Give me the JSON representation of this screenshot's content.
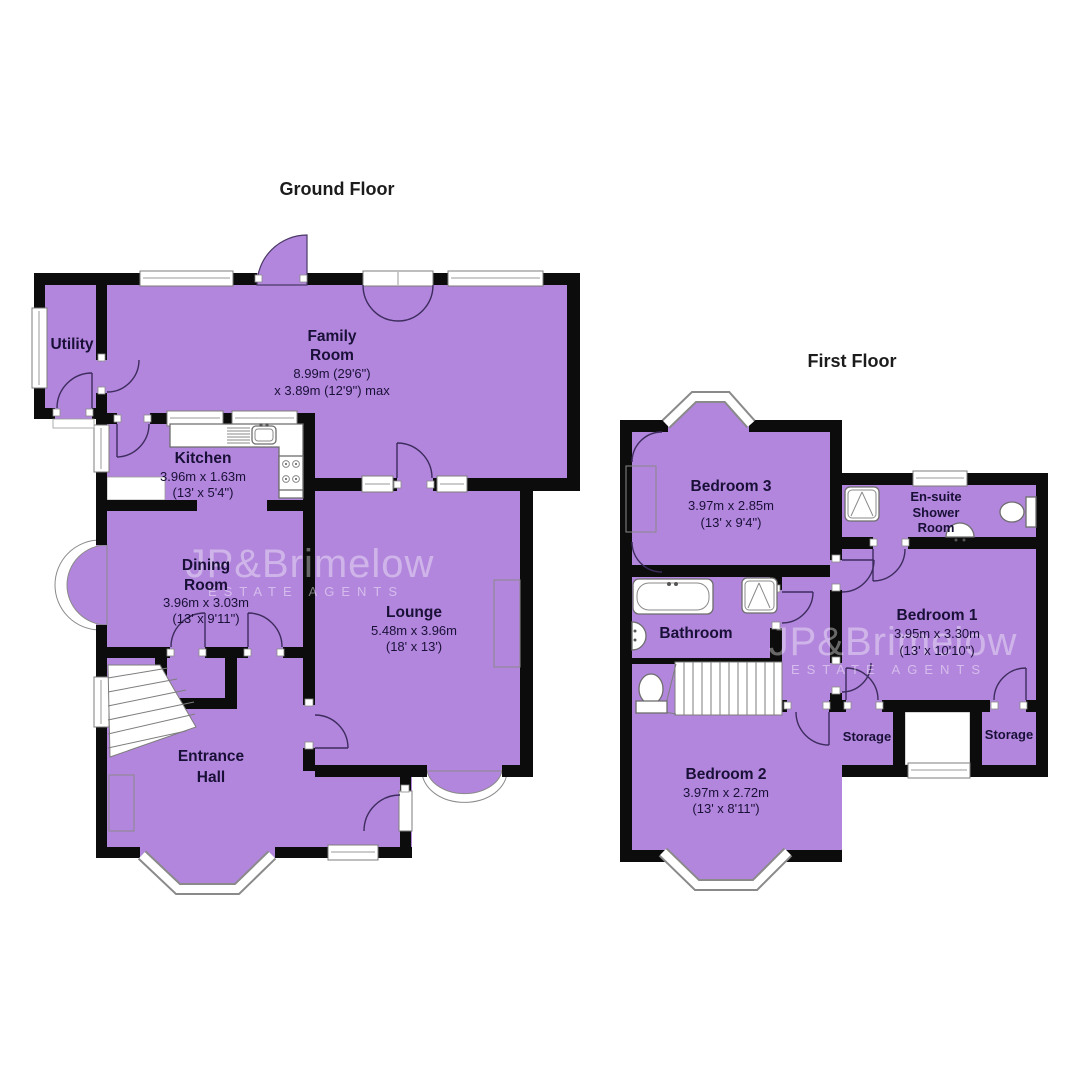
{
  "page": {
    "background": "#ffffff"
  },
  "colors": {
    "room_fill": "#b286dc",
    "wall": "#0c0c0c",
    "label_text": "#191038",
    "title_text": "#1c1c1c",
    "watermark": "rgba(255,255,255,0.40)"
  },
  "watermark": {
    "brand": "JP&Brimelow",
    "tagline": "ESTATE AGENTS"
  },
  "ground_floor": {
    "title": "Ground Floor",
    "rooms": {
      "utility": {
        "name": "Utility"
      },
      "family_room": {
        "name1": "Family",
        "name2": "Room",
        "dim1": "8.99m (29'6\")",
        "dim2": "x 3.89m (12'9\") max"
      },
      "kitchen": {
        "name": "Kitchen",
        "dim1": "3.96m x 1.63m",
        "dim2": "(13' x 5'4\")"
      },
      "dining_room": {
        "name1": "Dining",
        "name2": "Room",
        "dim1": "3.96m x 3.03m",
        "dim2": "(13' x 9'11\")"
      },
      "lounge": {
        "name": "Lounge",
        "dim1": "5.48m x 3.96m",
        "dim2": "(18' x 13')"
      },
      "entrance_hall": {
        "name1": "Entrance",
        "name2": "Hall"
      }
    }
  },
  "first_floor": {
    "title": "First Floor",
    "rooms": {
      "bedroom3": {
        "name": "Bedroom 3",
        "dim1": "3.97m x 2.85m",
        "dim2": "(13' x 9'4\")"
      },
      "ensuite": {
        "name1": "En-suite",
        "name2": "Shower",
        "name3": "Room"
      },
      "bathroom": {
        "name": "Bathroom"
      },
      "bedroom1": {
        "name": "Bedroom 1",
        "dim1": "3.95m x 3.30m",
        "dim2": "(13' x 10'10\")"
      },
      "bedroom2": {
        "name": "Bedroom 2",
        "dim1": "3.97m x 2.72m",
        "dim2": "(13' x 8'11\")"
      },
      "storage_left": {
        "name": "Storage"
      },
      "storage_right": {
        "name": "Storage"
      }
    }
  }
}
